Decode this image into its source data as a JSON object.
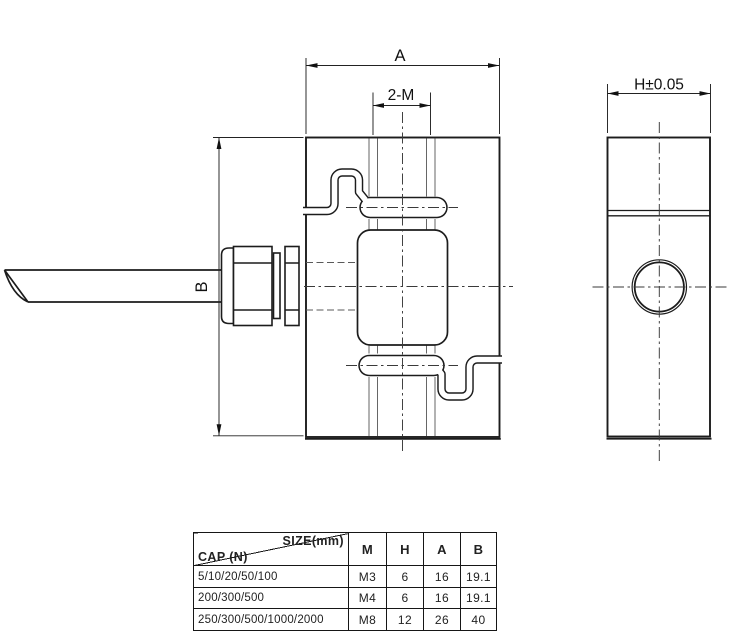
{
  "dimensions": {
    "front_width_label": "A",
    "thread_callout_label": "2-M",
    "front_height_label": "B",
    "side_width_label": "H±0.05"
  },
  "table": {
    "size_label": "SIZE(mm)",
    "cap_label": "CAP (N)",
    "columns": [
      "M",
      "H",
      "A",
      "B"
    ],
    "rows": [
      [
        "5/10/20/50/100",
        "M3",
        "6",
        "16",
        "19.1"
      ],
      [
        "200/300/500",
        "M4",
        "6",
        "16",
        "19.1"
      ],
      [
        "250/300/500/1000/2000",
        "M8",
        "12",
        "26",
        "40"
      ]
    ]
  },
  "colors": {
    "line": "#1c1c1c",
    "hidden_line": "#666666",
    "centerline": "#3a3a3a",
    "background": "#ffffff"
  }
}
